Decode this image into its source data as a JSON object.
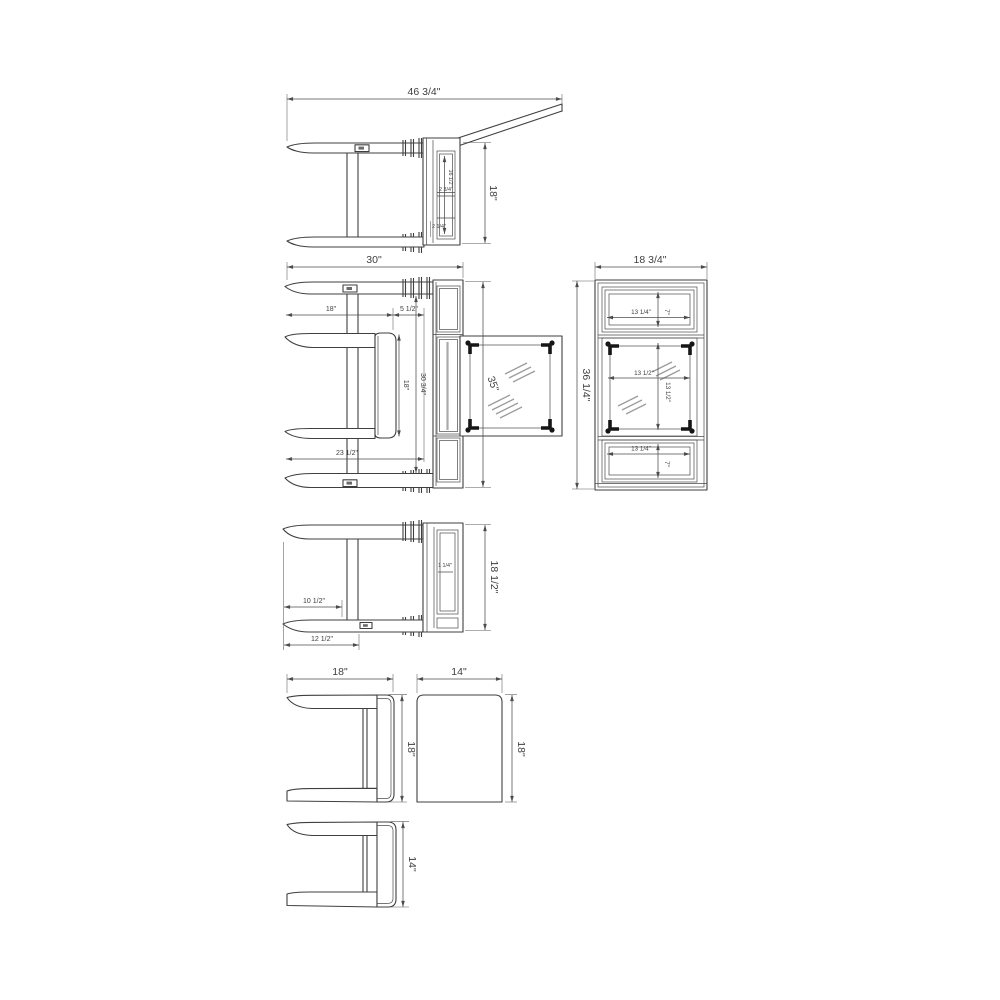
{
  "drawing": {
    "type": "furniture-dimension-diagram",
    "background": "#ffffff",
    "line_color": "#3f3f3f",
    "hatch_color": "#9c9c9c",
    "bracket_color": "#161616",
    "units": "inches"
  },
  "v1": {
    "top": "46 3/4\"",
    "height": "18\"",
    "panel_h": "16 1/2\"",
    "panel_d": "2 3/4\"",
    "panel_b": "2 1/4\""
  },
  "v2": {
    "top": "30\"",
    "depth": "18\"",
    "gap": "5 1/2\"",
    "stool_h": "18\"",
    "table_h": "30 3/4\"",
    "lower": "23 1/2\"",
    "leaf_h": "35\""
  },
  "v3": {
    "top": "18 3/4\"",
    "height": "36 1/4\"",
    "drawer_top_w": "13 1/4\"",
    "drawer_top_h": "7\"",
    "glass_w": "13 1/2\"",
    "glass_h": "13 1/2\"",
    "drawer_bot_w": "13 1/4\"",
    "drawer_bot_h": "7\""
  },
  "v4": {
    "height": "18 1/2\"",
    "inner_w": "10 1/2\"",
    "rail_w": "12 1/2\"",
    "panel": "1 1/4\""
  },
  "v5": {
    "top": "18\"",
    "height": "18\""
  },
  "v6": {
    "top": "14\"",
    "height": "18\""
  },
  "v7": {
    "height": "14\""
  }
}
